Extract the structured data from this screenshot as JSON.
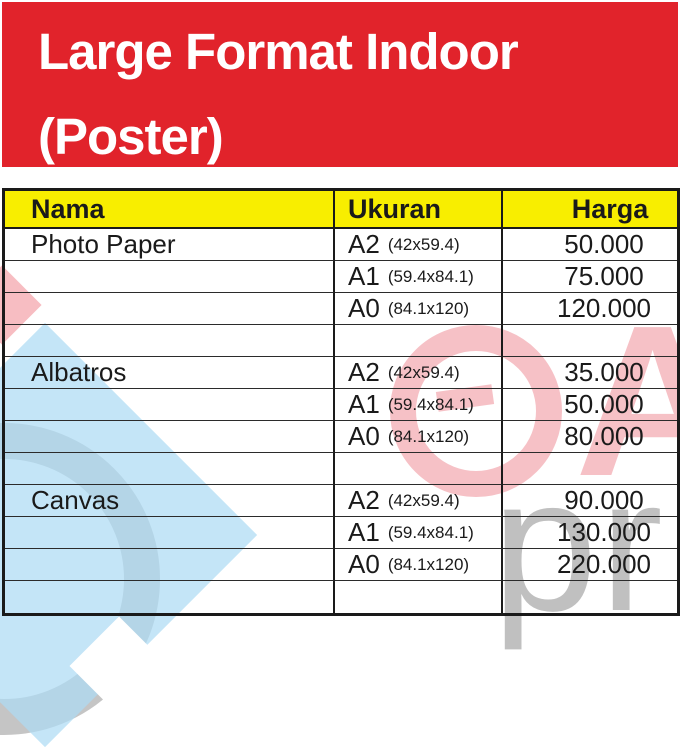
{
  "banner": {
    "title_line1": "Large Format Indoor",
    "title_line2": "(Poster)"
  },
  "table": {
    "headers": {
      "name": "Nama",
      "size": "Ukuran",
      "price": "Harga"
    },
    "rows": [
      {
        "name": "Photo Paper",
        "size": "A2",
        "dim": "(42x59.4)",
        "price": "50.000"
      },
      {
        "name": "",
        "size": "A1",
        "dim": "(59.4x84.1)",
        "price": "75.000"
      },
      {
        "name": "",
        "size": "A0",
        "dim": "(84.1x120)",
        "price": "120.000"
      },
      {
        "name": "",
        "size": "",
        "dim": "",
        "price": ""
      },
      {
        "name": "Albatros",
        "size": "A2",
        "dim": "(42x59.4)",
        "price": "35.000"
      },
      {
        "name": "",
        "size": "A1",
        "dim": "(59.4x84.1)",
        "price": "50.000"
      },
      {
        "name": "",
        "size": "A0",
        "dim": "(84.1x120)",
        "price": "80.000"
      },
      {
        "name": "",
        "size": "",
        "dim": "",
        "price": ""
      },
      {
        "name": "Canvas",
        "size": "A2",
        "dim": "(42x59.4)",
        "price": "90.000"
      },
      {
        "name": "",
        "size": "A1",
        "dim": "(59.4x84.1)",
        "price": "130.000"
      },
      {
        "name": "",
        "size": "A0",
        "dim": "(84.1x120)",
        "price": "220.000"
      },
      {
        "name": "",
        "size": "",
        "dim": "",
        "price": ""
      }
    ]
  },
  "watermark": {
    "gray_letters": "pr",
    "pink_letter": "A"
  },
  "colors": {
    "banner_red": "#e1232b",
    "header_yellow": "#f8ee00",
    "line_black": "#1a1a1a",
    "watermark_blue": "#cfe8f7",
    "watermark_pink": "#eb9aa2",
    "watermark_gray": "#b5b5b5"
  }
}
